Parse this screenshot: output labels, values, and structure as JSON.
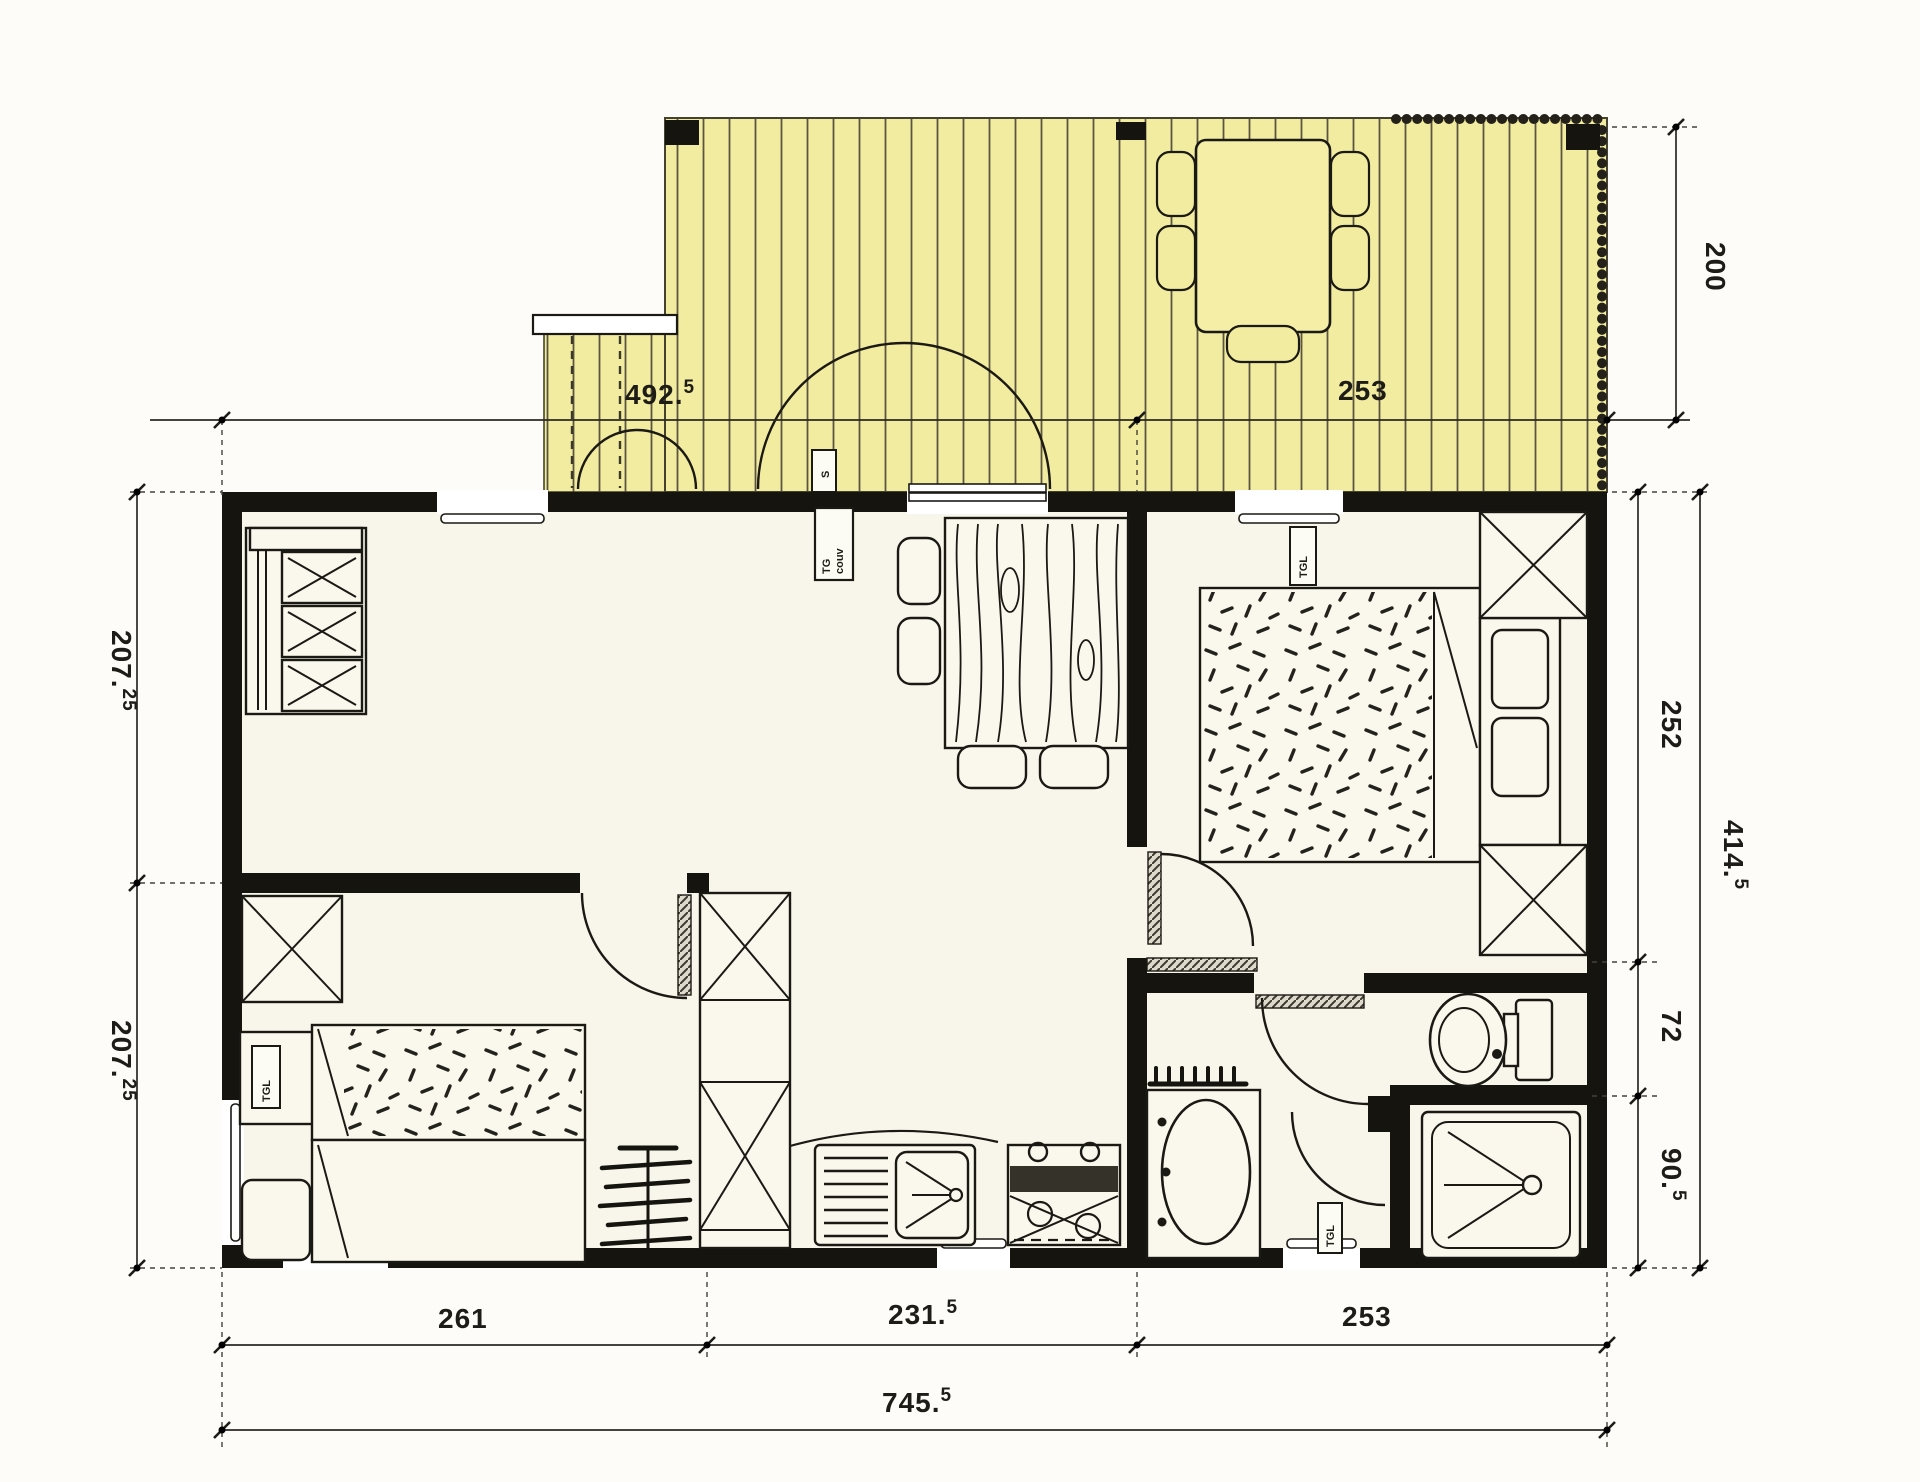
{
  "drawing": {
    "type": "floor-plan",
    "colors": {
      "deck": "#f2eca0",
      "wall": "#16140f",
      "floor": "#f8f5ea",
      "page": "#fdfcf8"
    }
  },
  "dims": {
    "deck_left": {
      "text": "492.5",
      "main": "492.",
      "sup": "5"
    },
    "deck_right": {
      "text": "253",
      "main": "253",
      "sup": ""
    },
    "deck_depth": {
      "text": "200",
      "main": "200",
      "sup": ""
    },
    "left_upper": {
      "text": "207.25",
      "main": "207.",
      "sup": "25"
    },
    "left_lower": {
      "text": "207.25",
      "main": "207.",
      "sup": "25"
    },
    "right_bedroom": {
      "text": "252",
      "main": "252",
      "sup": ""
    },
    "right_wc": {
      "text": "72",
      "main": "72",
      "sup": ""
    },
    "right_shower": {
      "text": "90.5",
      "main": "90.",
      "sup": "5"
    },
    "right_total": {
      "text": "414.5",
      "main": "414.",
      "sup": "5"
    },
    "bottom_left": {
      "text": "261",
      "main": "261",
      "sup": ""
    },
    "bottom_middle": {
      "text": "231.5",
      "main": "231.",
      "sup": "5"
    },
    "bottom_right": {
      "text": "253",
      "main": "253",
      "sup": ""
    },
    "bottom_total": {
      "text": "745.5",
      "main": "745.",
      "sup": "5"
    }
  },
  "unit_labels": {
    "deck_switch": "S",
    "entry_panel_line1": "TG",
    "entry_panel_line2": "couv",
    "bedroom_heater": "TGL",
    "bedroom2_heater": "TGL",
    "bathroom_heater": "TGL"
  }
}
